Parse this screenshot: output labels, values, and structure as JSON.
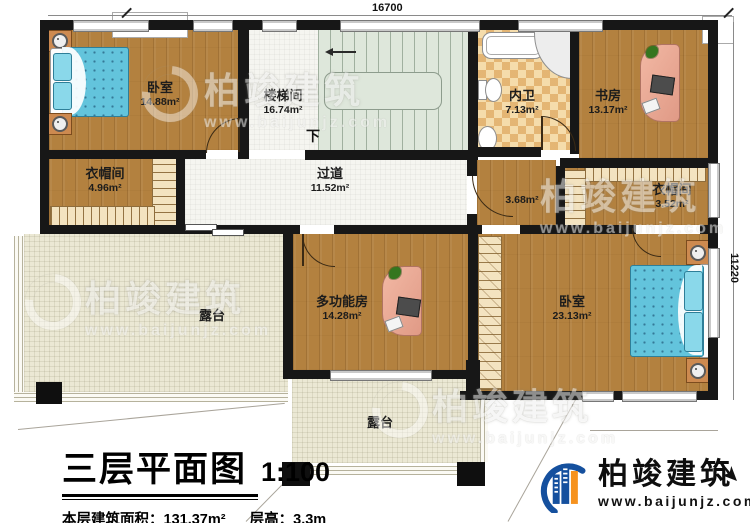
{
  "plan": {
    "title": "三层平面图",
    "scale": "1:100",
    "area_label": "本层建筑面积：",
    "area_value": "131.37m²",
    "floor_height_label": "层高：",
    "floor_height_value": "3.3m"
  },
  "dimensions": {
    "top": "16700",
    "right": "11220"
  },
  "rooms": [
    {
      "name": "卧室",
      "area": "14.88m²"
    },
    {
      "name": "楼梯间",
      "area": "16.74m²"
    },
    {
      "name": "内卫",
      "area": "7.13m²"
    },
    {
      "name": "书房",
      "area": "13.17m²"
    },
    {
      "name": "衣帽间",
      "area": "4.96m²"
    },
    {
      "name": "过道",
      "area": "11.52m²"
    },
    {
      "name": "",
      "area": "3.68m²"
    },
    {
      "name": "衣帽间",
      "area": "3.52m²"
    },
    {
      "name": "多功能房",
      "area": "14.28m²"
    },
    {
      "name": "卧室",
      "area": "23.13m²"
    },
    {
      "name": "露台",
      "area": ""
    },
    {
      "name": "露台",
      "area": ""
    }
  ],
  "annotations": {
    "stairs_down": "下"
  },
  "watermark": {
    "brand": "柏竣建筑",
    "url": "www.baijunjz.com"
  },
  "logo": {
    "brand": "柏竣建筑",
    "url": "www.baijunjz.com"
  },
  "colors": {
    "wood": "#b3813f",
    "wall": "#171717",
    "terrace": "#ebe8d4",
    "stair": "#dee7db",
    "tile": "#f5dcab",
    "bed": "#63c4dc",
    "logo_blue": "#15509e",
    "logo_orange": "#f6921e"
  }
}
